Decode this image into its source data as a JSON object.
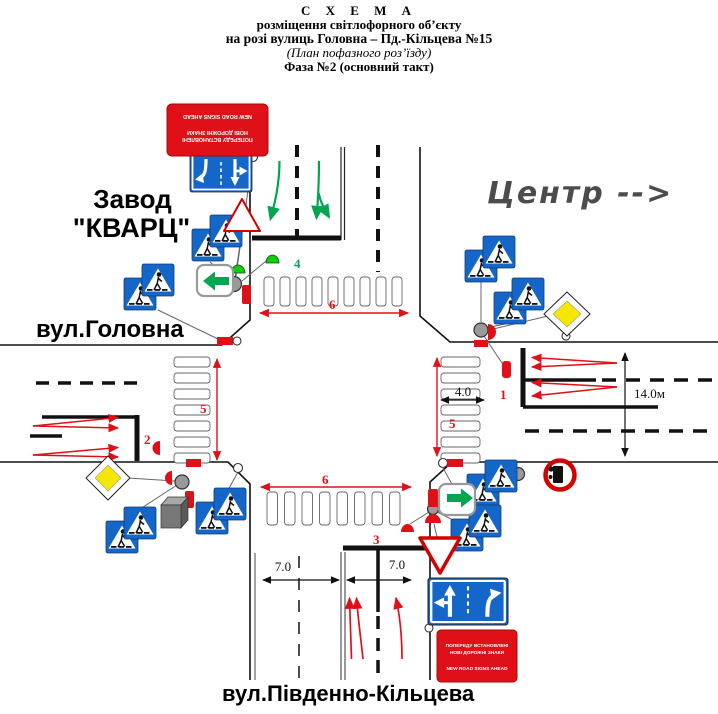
{
  "header": {
    "line1": "С Х Е М А",
    "line2": "розміщення світлофорного об’єкту",
    "line3": "на розі вулиць Головна – Пд.-Кільцева №15",
    "line4": "(План пофазного роз’їзду)",
    "line5": "Фаза №2 (основний такт)"
  },
  "labels": {
    "factory_line1": "Завод",
    "factory_line2": "\"КВАРЦ\"",
    "street_west": "вул.Головна",
    "street_south": "вул.Південно-Кільцева",
    "direction_center": "Центр -->"
  },
  "dimensions": {
    "crosswalk_north_width": "6",
    "crosswalk_south_width": "6",
    "crosswalk_west_length": "5",
    "crosswalk_east_length": "5",
    "crosswalk_east_width": "4.0",
    "road_east_width": "14.0м",
    "lane_south_left": "7.0",
    "lane_south_right": "7.0"
  },
  "signal_groups": {
    "group1": "1",
    "group2": "2",
    "group3": "3",
    "group4": "4"
  },
  "signs": {
    "new_signs_line1": "ПОПЕРЕДУ ВСТАНОВЛЕНІ",
    "new_signs_line2": "НОВІ ДОРОЖНІ ЗНАКИ",
    "new_signs_line3": "NEW ROAD SIGNS AHEAD"
  },
  "colors": {
    "accent_red": "#e01018",
    "accent_green": "#00a550",
    "sign_blue": "#1467c8",
    "priority_yellow": "#f4e800",
    "pole_gray": "#9a9a9a"
  }
}
